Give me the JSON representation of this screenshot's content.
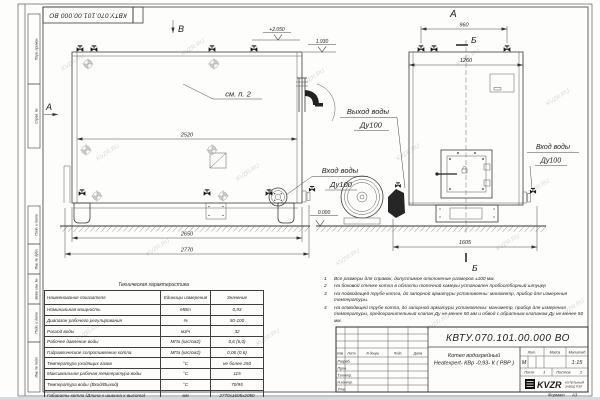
{
  "sheet": {
    "top_designation": "КВТУ.070.101.00.000 ВО",
    "format_label": "Формат",
    "format_value": "А3",
    "margin_stamps": [
      "Перв. примен.",
      "Справ. №",
      "Подп. и дата",
      "Инв. № дубл.",
      "Взам. инв. №",
      "Подп. и дата",
      "Инв. № подл."
    ],
    "watermark": "KVZR.RU"
  },
  "drawing": {
    "view_labels": {
      "top_view_b": "В",
      "side_a": "А",
      "front_a": "А",
      "section_b_top": "Б",
      "section_b_bottom": "Б"
    },
    "callout_see_item": "см. п. 2",
    "dims": {
      "shell_length": "2520",
      "base_length": "2650",
      "overall_length": "2770",
      "top_ports_spacing": "960",
      "front_width": "1260",
      "overall_width": "1605"
    },
    "elevations": {
      "top": "+2.050",
      "outlet": "1.930",
      "ground": "0.000"
    },
    "ports": {
      "outlet_l1": "Выход воды",
      "outlet_l2": "Ду100",
      "inlet_side_l1": "Вход воды",
      "inlet_side_l2": "Ду100",
      "inlet_front_l1": "Вход воды",
      "inlet_front_l2": "Ду100"
    }
  },
  "tech_table": {
    "title": "Техническая характеристика",
    "headers": [
      "Наименование показателя",
      "Единицы измерения",
      "Значение"
    ],
    "rows": [
      [
        "Номинальная мощность",
        "МВт",
        "0,93"
      ],
      [
        "Диапазон рабочего регулирования",
        "%",
        "50-100"
      ],
      [
        "Расход воды",
        "м3/ч",
        "32"
      ],
      [
        "Рабочее давление воды",
        "МПа (кгс/см2)",
        "0,6 (6,0)"
      ],
      [
        "Гидравлическое сопротивление котла",
        "МПа (кгс/см2)",
        "0,06 (0,6)"
      ],
      [
        "Температура уходящих газов",
        "°С",
        "не более 250"
      ],
      [
        "Максимальная рабочая температура воды",
        "°С",
        "115"
      ],
      [
        "Температура воды (Вход/Выход)",
        "°С",
        "70/95"
      ],
      [
        "Габариты котла (Длина х ширина х высота)",
        "мм",
        "2770х1605х2050"
      ]
    ]
  },
  "notes": [
    {
      "num": "1",
      "text": "Все размеры для справок, допустимое отклонение размеров ±100 мм."
    },
    {
      "num": "2",
      "text": "На боковой стенке котла в области топочной камеры установлен пробоотборный штуцер"
    },
    {
      "num": "3",
      "text": "На подводящей трубе котла, до запорной арматуры установлены: манометр, прибор для измерения температуры."
    },
    {
      "num": "4",
      "text": "На отводящей трубе котла, до запорной арматуры установлены: манометр, прибор для измерения температуры, предохранительный клапан Ду не менее 50 мм и обвод с обратным клапаном Ду не менее 50 мм."
    }
  ],
  "title_block": {
    "designation": "КВТУ.070.101.00.000 ВО",
    "product_line1": "Котел водогрейный",
    "product_line2": "Heatexpert- КВр -0,93- К ( РВР )",
    "header_cells": [
      "Изм.",
      "Лист",
      "N докум.",
      "Подп.",
      "Дата"
    ],
    "staff": [
      "Разраб.",
      "Пров.",
      "Т.контр.",
      "Н.контр.",
      "Утв."
    ],
    "lit_label": "Лит.",
    "lit_value": "М",
    "mass_label": "Масса",
    "scale_label": "Масштаб",
    "scale_value": "1:15",
    "sheet_label": "Лист",
    "sheet_value": "1",
    "sheets_label": "Листов",
    "sheets_value": "2",
    "logo_text": "KVZR",
    "logo_caption1": "КОТЕЛЬНЫЙ",
    "logo_caption2": "ЗАВОД РЭП"
  }
}
